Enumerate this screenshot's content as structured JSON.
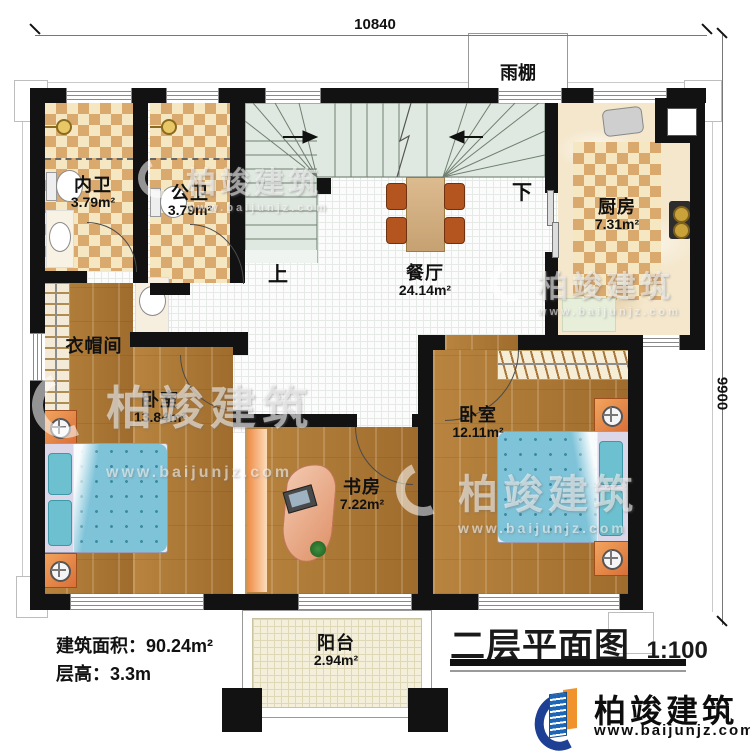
{
  "dimensions": {
    "width_mm": "10840",
    "height_mm": "9900"
  },
  "canopy_label": "雨棚",
  "stairs": {
    "up": "上",
    "down": "下"
  },
  "rooms": {
    "bath_inner": {
      "name": "内卫",
      "area": "3.79m²"
    },
    "bath_public": {
      "name": "公卫",
      "area": "3.79m²"
    },
    "kitchen": {
      "name": "厨房",
      "area": "7.31m²"
    },
    "dining": {
      "name": "餐厅",
      "area": "24.14m²"
    },
    "cloakroom": {
      "name": "衣帽间"
    },
    "bedroom_left": {
      "name": "卧室",
      "area": "13.84m²"
    },
    "bedroom_right": {
      "name": "卧室",
      "area": "12.11m²"
    },
    "study": {
      "name": "书房",
      "area": "7.22m²"
    },
    "balcony": {
      "name": "阳台",
      "area": "2.94m²"
    }
  },
  "info": {
    "build_area": "建筑面积：90.24m²",
    "floor_height": "层高：3.3m"
  },
  "title": {
    "text": "二层平面图",
    "scale": "1:100"
  },
  "brand": {
    "name": "柏竣建筑",
    "url": "www.baijunjz.com"
  },
  "watermark": {
    "text": "柏竣建筑",
    "url": "www.baijunjz.com"
  },
  "colors": {
    "wall": "#121212",
    "tile_accent": "#d9a96e",
    "wood": "#ad7935",
    "stair": "#e0e9e1",
    "bed_blue": "#7fc3d9",
    "brand_blue": "#1d66b5",
    "brand_orange": "#f0932c",
    "brand_navy": "#1d3f94"
  }
}
